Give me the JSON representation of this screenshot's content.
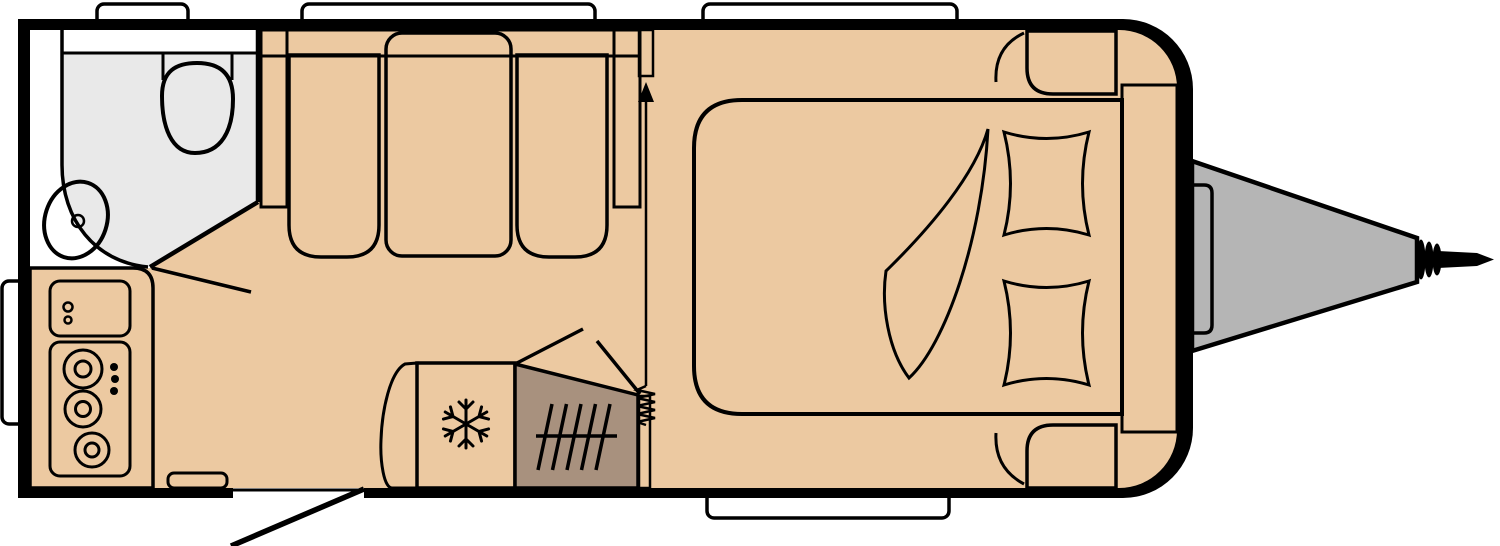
{
  "diagram": {
    "title": "Caravan floor plan",
    "type": "floorplan",
    "orientation": "hitch-on-right"
  },
  "colors": {
    "outline_black": "#000000",
    "exterior_white": "#ffffff",
    "floor_tan": "#ecc9a1",
    "washroom_gray": "#e9e9e9",
    "fixture_white": "#ffffff",
    "basin_gray": "#ededed",
    "seat_blue": "#4a94c4",
    "backrest_blue": "#6fa0ca",
    "table_blue": "#c8daee",
    "bed_orange": "#f49a66",
    "bedding_brown": "#ce8c5b",
    "cabinet_brown": "#ab9480",
    "wardrobe_brown": "#9f8873",
    "heater_brown": "#a8917e",
    "kitchen_cream": "#f8e5b2",
    "appliance_cream": "#fdf6de",
    "fridge_cream": "#fae9be",
    "storage_gray": "#b5b5b5",
    "hitch_gray": "#b5b5b5",
    "panel_gray": "#9c9c9c"
  },
  "rooms": {
    "washroom": {
      "features": [
        "toilet",
        "washbasin",
        "vanity-counter",
        "angled-door"
      ]
    },
    "dinette": {
      "features": [
        "bench-seat-left",
        "bench-seat-right",
        "table",
        "backrest"
      ]
    },
    "kitchen": {
      "features": [
        "sink-unit",
        "hob-3-burner",
        "control-knobs"
      ]
    },
    "mid_section": {
      "features": [
        "wardrobe",
        "refrigerator",
        "blown-air-heater",
        "concertina-divider",
        "direction-arrow"
      ]
    },
    "bedroom": {
      "features": [
        "fixed-double-bed",
        "duvet",
        "pillow-top",
        "pillow-bottom",
        "overhead-locker-top",
        "overhead-locker-bottom"
      ]
    },
    "front": {
      "features": [
        "front-storage-locker",
        "a-frame-drawbar",
        "hitch-coupling",
        "drawbar-hatch"
      ]
    },
    "entrance": {
      "features": [
        "door-opening",
        "door-swing",
        "step"
      ]
    }
  },
  "windows": {
    "top_count": 3,
    "bottom_count": 1,
    "left_count": 1
  }
}
